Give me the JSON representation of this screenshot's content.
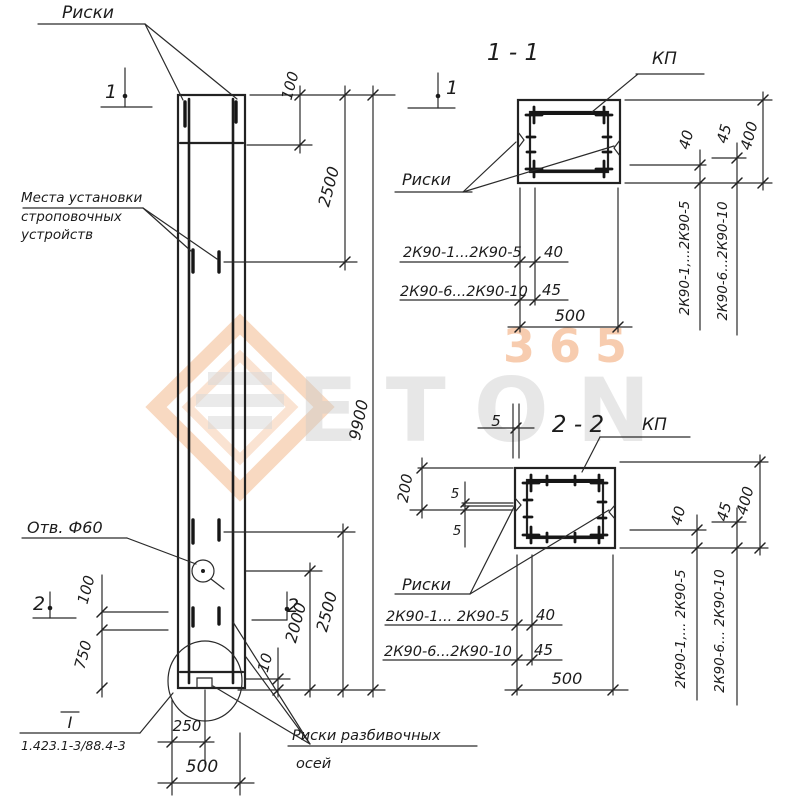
{
  "watermark": {
    "number": "365",
    "brand": "ETON"
  },
  "main": {
    "riski_top": "Риски",
    "strop1": "Места установки",
    "strop2": "строповочных",
    "strop3": "устройств",
    "hole": "Отв. Ф60",
    "ref_roman": "I",
    "ref_doc": "1.423.1-3/88.4-3",
    "razbiv1": "Риски разбивочных",
    "razbiv2": "осей",
    "flag1_left": "1",
    "flag1_right": "1",
    "flag2_left": "2",
    "flag2_right": "2",
    "dim_top_100": "100",
    "dim_top_2500": "2500",
    "dim_9900": "9900",
    "dim_left_100": "100",
    "dim_left_750": "750",
    "dim_10": "10",
    "dim_2000": "2000",
    "dim_2500": "2500",
    "dim_250": "250",
    "dim_500": "500"
  },
  "section11": {
    "title": "1 - 1",
    "kp": "КП",
    "riski": "Риски",
    "row1_label": "2К90-1...2К90-5",
    "row1_value": "40",
    "row2_label": "2К90-6...2К90-10",
    "row2_value": "45",
    "dim_width": "500",
    "dim_40": "40",
    "dim_45": "45",
    "dim_400": "400",
    "rot1": "2К90-1,...2К90-5",
    "rot2": "2К90-6...2К90-10"
  },
  "section22": {
    "title": "2 - 2",
    "kp": "КП",
    "riski": "Риски",
    "dim_5_top": "5",
    "dim_200": "200",
    "dim_5_a": "5",
    "dim_5_b": "5",
    "row1_label": "2К90-1... 2К90-5",
    "row1_value": "40",
    "row2_label": "2К90-6...2К90-10",
    "row2_value": "45",
    "dim_width": "500",
    "dim_40": "40",
    "dim_45": "45",
    "dim_400": "400",
    "rot1": "2К90-1,... 2К90-5",
    "rot2": "2К90-6... 2К90-10"
  }
}
